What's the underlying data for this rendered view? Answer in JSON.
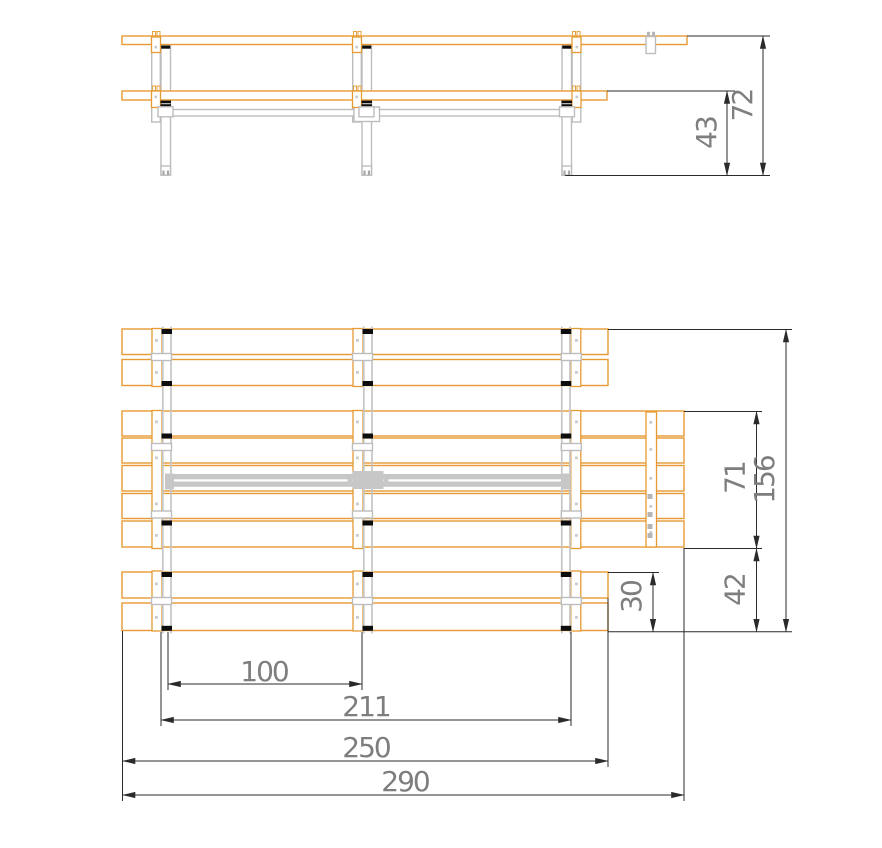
{
  "drawing": {
    "kind": "technical-drawing",
    "subject": "garden bench / table frame",
    "views": {
      "top": "front elevation",
      "bottom": "plan view from above"
    }
  },
  "dimensions": {
    "elevation": {
      "overall_height": "72",
      "seat_height": "43"
    },
    "plan": {
      "total_depth": "156",
      "seat_group_depth": "71",
      "seat_to_bench_edge": "42",
      "bench_group_depth": "30",
      "leg_bay_spacing": "100",
      "outer_leg_span": "211",
      "short_plank_length": "250",
      "long_plank_length": "290"
    }
  },
  "colors": {
    "plank_outline": "#E69A33",
    "metal_gray": "#C5C5C5",
    "bracket_gray": "#BDBDBD",
    "clip_black": "#0D0D0D",
    "dimension_line": "#2B2B2B",
    "dimension_text": "#7E7E7E",
    "background": "#FFFFFF"
  }
}
